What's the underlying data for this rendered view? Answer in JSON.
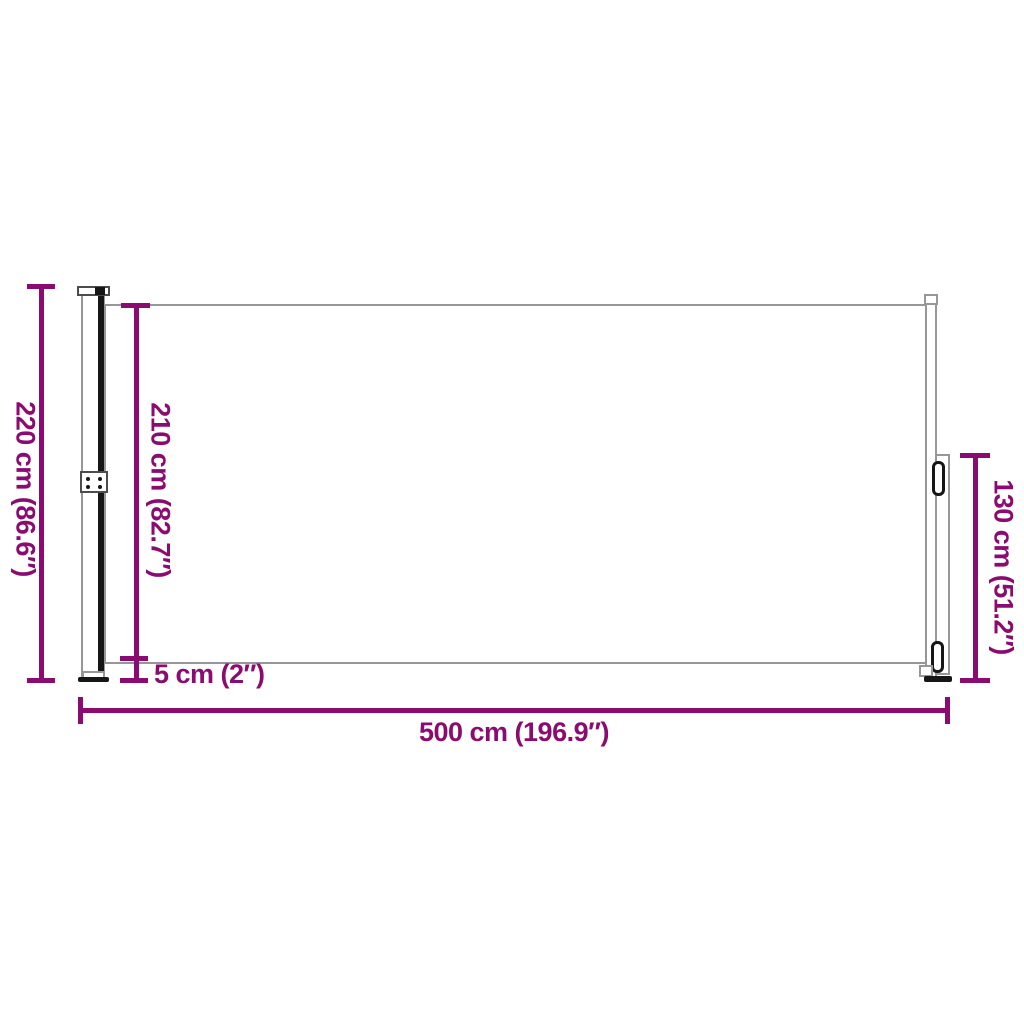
{
  "dimensions": {
    "total_height": "220 cm (86.6″)",
    "fabric_height": "210 cm (82.7″)",
    "ground_clearance": "5 cm (2″)",
    "pole_height": "130 cm (51.2″)",
    "total_length": "500 cm (196.9″)"
  },
  "colors": {
    "dimension_accent": "#8A0C70",
    "outline_gray": "#979797",
    "detail_black": "#161616",
    "background": "#FFFFFF"
  }
}
